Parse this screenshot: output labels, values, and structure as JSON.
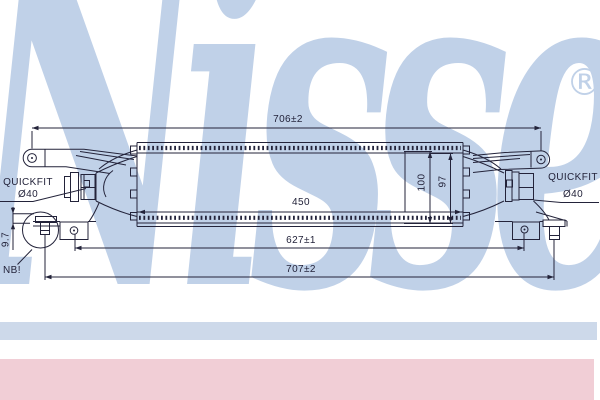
{
  "watermark": {
    "text": "Nissens",
    "registered_mark": "®"
  },
  "drawing": {
    "labels": {
      "quickfit_left_line1": "QUICKFIT",
      "quickfit_left_line2": "Ø40",
      "quickfit_right_line1": "QUICKFIT",
      "quickfit_right_line2": "Ø40",
      "note": "NB!"
    },
    "dimensions": {
      "overall_top": "706±2",
      "core_length": "450",
      "mount_hole_span": "627±1",
      "overall_bottom": "707±2",
      "height_outer": "100",
      "height_core": "97",
      "pin_offset": "9.7"
    }
  },
  "theme": {
    "line_color": "#23233a",
    "watermark_color": "#c0d1e8",
    "stripe_blue": "#cdd9ea",
    "stripe_pink": "#f1ced6",
    "background": "#ffffff"
  }
}
